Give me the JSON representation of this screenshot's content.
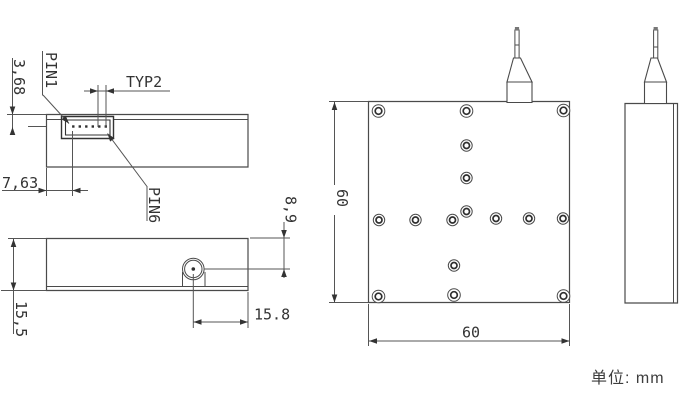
{
  "drawing": {
    "labels": {
      "pin1": "PIN1",
      "pin6": "PIN6",
      "typ2": "TYP2"
    },
    "dimensions": {
      "connector_pin_depth": "3,68",
      "edge_to_pin1": "7,63",
      "module_height": "15,5",
      "port_center_offset": "8,9",
      "port_from_right_edge": "15.8",
      "top_view_height": "60",
      "top_view_width": "60"
    },
    "note": {
      "unit_label": "单位:  mm"
    }
  }
}
